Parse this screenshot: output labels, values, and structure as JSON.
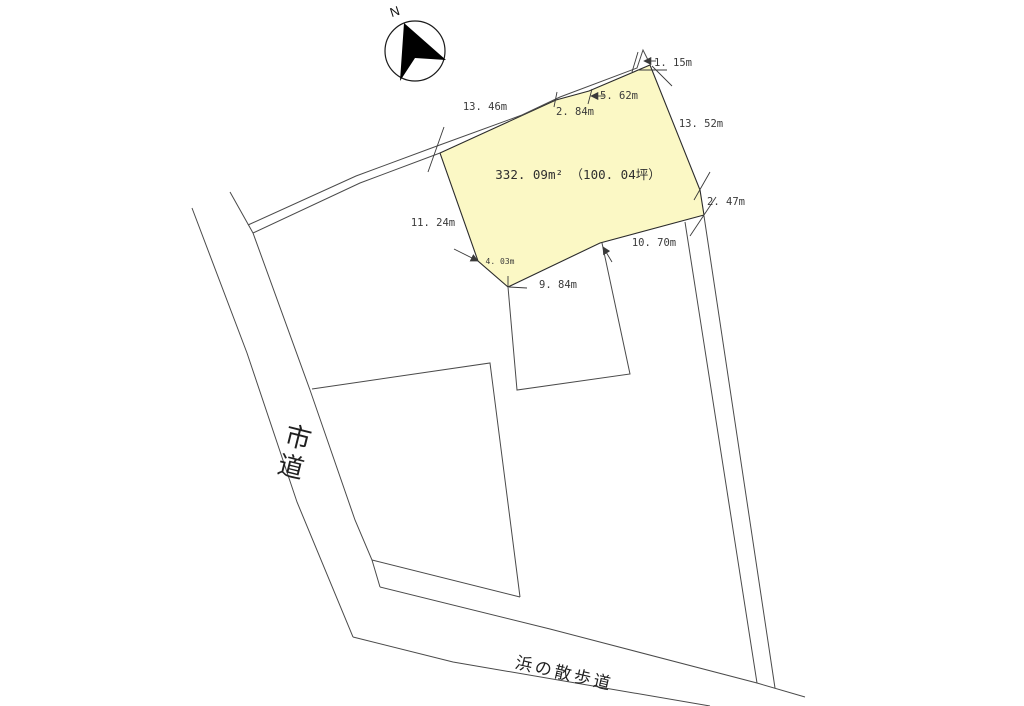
{
  "compass": {
    "label": "N"
  },
  "plot": {
    "area_label": "332. 09m² （100. 04坪）"
  },
  "measurements": [
    {
      "id": "edge-13-46",
      "label": "13. 46m"
    },
    {
      "id": "edge-2-84",
      "label": "2. 84m"
    },
    {
      "id": "edge-5-62",
      "label": "5. 62m"
    },
    {
      "id": "edge-1-15",
      "label": "1. 15m"
    },
    {
      "id": "edge-13-52",
      "label": "13. 52m"
    },
    {
      "id": "edge-2-47",
      "label": "2. 47m"
    },
    {
      "id": "edge-10-70",
      "label": "10. 70m"
    },
    {
      "id": "edge-9-84",
      "label": "9. 84m"
    },
    {
      "id": "edge-4-03",
      "label": "4. 03m"
    },
    {
      "id": "edge-11-24",
      "label": "11. 24m"
    }
  ],
  "roads": {
    "city_road": "市道",
    "promenade": "浜の散歩道"
  },
  "colors": {
    "plot_fill": "#FBF8C5",
    "boundary_line": "#4a4a4a",
    "text": "#3a3a3a"
  }
}
